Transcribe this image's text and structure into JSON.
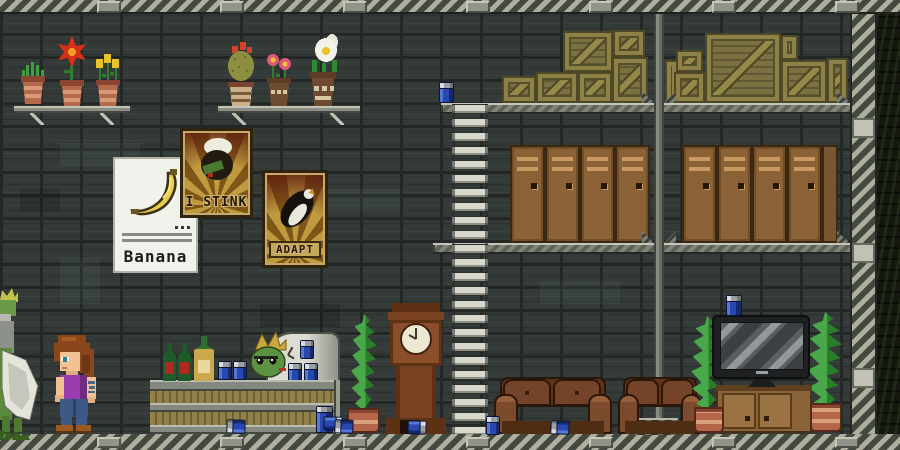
{
  "scene": {
    "description": "2D pixel-art sandbox game: industrial station interior with bar lounge, storage lockers and crate loft"
  },
  "posters": {
    "banana": {
      "title": "Banana"
    },
    "stink": {
      "title": "I STINK"
    },
    "adapt": {
      "title": "ADAPT"
    }
  },
  "palette": {
    "wall": "#333a38",
    "hazard_light": "#aeae9e",
    "hazard_dark": "#44493f",
    "crate_olive": "#7b7140",
    "locker_brown": "#8a6236",
    "mug_blue": "#2848b0",
    "couch_brown": "#74432a",
    "poster_gold": "#c09a3e",
    "poster_shadow": "#7d5618",
    "plant_green": "#2a7e2a",
    "metal_platform": "#81847a"
  },
  "inventory": [
    {
      "item": "potted shelf plant",
      "count": 6
    },
    {
      "item": "floor plant",
      "count": 3
    },
    {
      "item": "wooden crate",
      "count": 13
    },
    {
      "item": "storage locker",
      "count": 9
    },
    {
      "item": "beer mug",
      "count": 13
    },
    {
      "item": "wine bottle",
      "count": 2
    },
    {
      "item": "champagne bottle",
      "count": 1
    },
    {
      "item": "couch",
      "count": 2
    },
    {
      "item": "flatscreen tv",
      "count": 1
    },
    {
      "item": "grandfather clock",
      "count": 1
    },
    {
      "item": "ladder",
      "count": 1
    }
  ]
}
